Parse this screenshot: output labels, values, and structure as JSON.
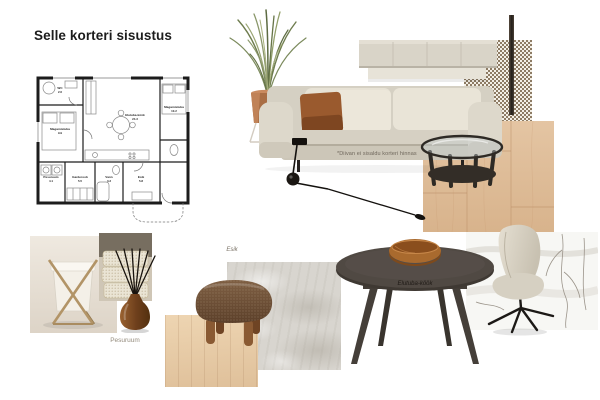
{
  "board": {
    "title": "Selle korteri sisustus",
    "background": "#ffffff"
  },
  "floorplan": {
    "rooms": [
      {
        "name": "WC",
        "area": "2.6"
      },
      {
        "name": "Magamistuba",
        "area": "9.9"
      },
      {
        "name": "Elutuba-köök",
        "area": "24.3"
      },
      {
        "name": "Magamistuba",
        "area": "10.2"
      },
      {
        "name": "Pesuruum",
        "area": "4.1"
      },
      {
        "name": "Garderoob",
        "area": "5.5"
      },
      {
        "name": "Vann",
        "area": "3.3"
      },
      {
        "name": "Esik",
        "area": "5.8"
      }
    ]
  },
  "annotations": {
    "sofa_note": "*Diivan ei sisaldu korteri hinnas",
    "laundry_label": "Pesuruum",
    "hall_label": "Esik",
    "living_label": "Elutuba-köök"
  },
  "items": {
    "floor_plan": "apartment-floor-plan",
    "plant": "tall-grass-plant-in-copper-pot",
    "sofa": "beige-sofa-with-rust-pillow",
    "cabinet": "wall-mounted-beige-sideboard",
    "fabric": "checkered-fabric-swatch",
    "lamp_pole": "floor-lamp-pole",
    "wall_lamp": "black-swing-arm-wall-lamp",
    "coffee_table": "dark-round-glass-coffee-table",
    "oak_right": "oak-flooring-swatch",
    "oak_bottom": "oak-flooring-swatch",
    "travertine": "travertine-stone-swatch",
    "hamper": "laundry-hamper-photo",
    "towels": "folded-towels-photo",
    "diffuser": "amber-reed-diffuser",
    "pouf": "brown-boucle-pouf",
    "table": "round-grey-dining-table",
    "bowl": "wooden-bowl",
    "chair": "beige-swivel-dining-chair",
    "backdrop": "marble-with-branches-texture"
  },
  "palette": {
    "rust": "#9a5a2e",
    "sofa_beige": "#d9d4c8",
    "oak": "#ddbb97",
    "travertine": "#d8d5cf",
    "pouf_brown": "#755741",
    "table_grey": "#4e4842",
    "amber_glass": "#8a5a2c"
  }
}
